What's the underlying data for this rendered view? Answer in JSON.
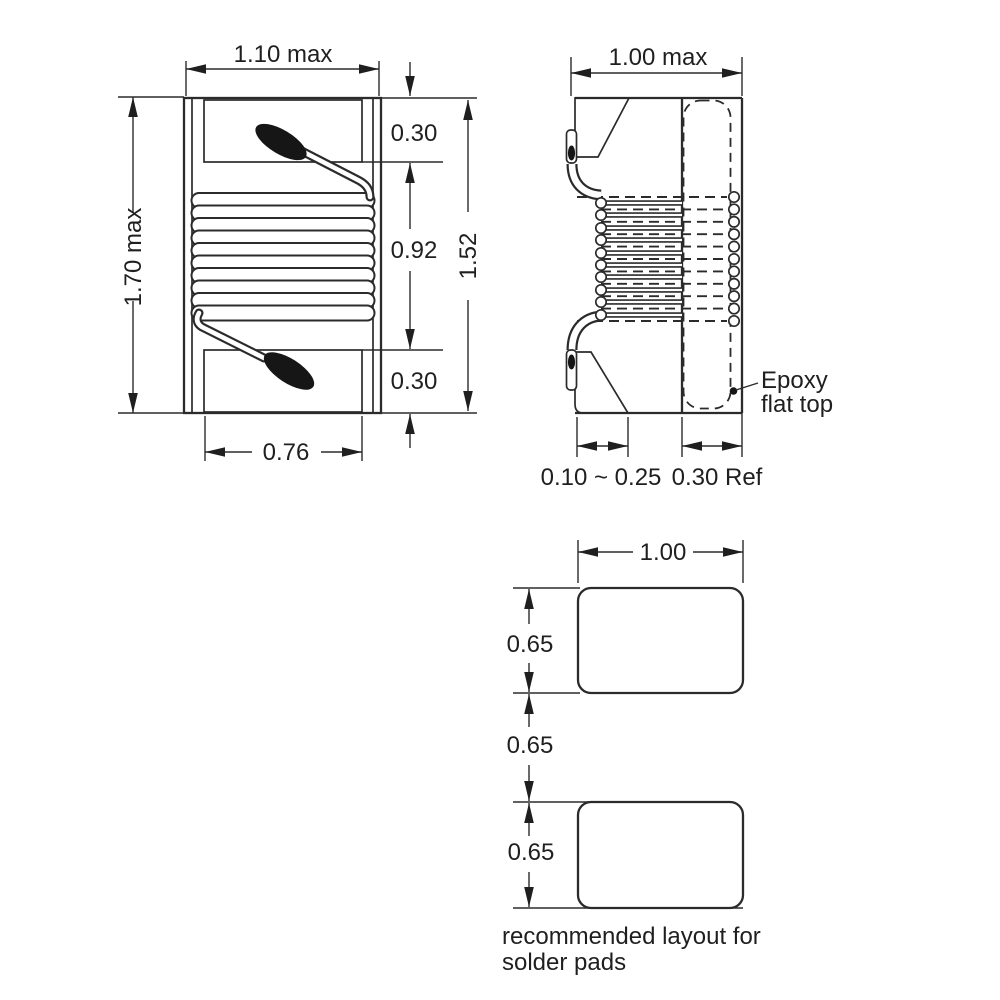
{
  "drawing": {
    "front_view": {
      "width_label": "1.10 max",
      "height_label": "1.70 max",
      "top_terminal_label": "0.30",
      "winding_label": "0.92",
      "bottom_terminal_label": "0.30",
      "body_label": "1.52",
      "terminal_width_label": "0.76"
    },
    "side_view": {
      "width_label": "1.00 max",
      "wire_end_label": "0.10 ~ 0.25",
      "flange_label": "0.30 Ref",
      "epoxy_note_line1": "Epoxy",
      "epoxy_note_line2": "flat top"
    },
    "pad_layout": {
      "width_label": "1.00",
      "pad1_height_label": "0.65",
      "gap_label": "0.65",
      "pad2_height_label": "0.65",
      "caption_line1": "recommended layout for",
      "caption_line2": "solder pads"
    },
    "colors": {
      "ink": "#2b2b2b",
      "text": "#1f1f1f",
      "background": "#ffffff"
    }
  }
}
